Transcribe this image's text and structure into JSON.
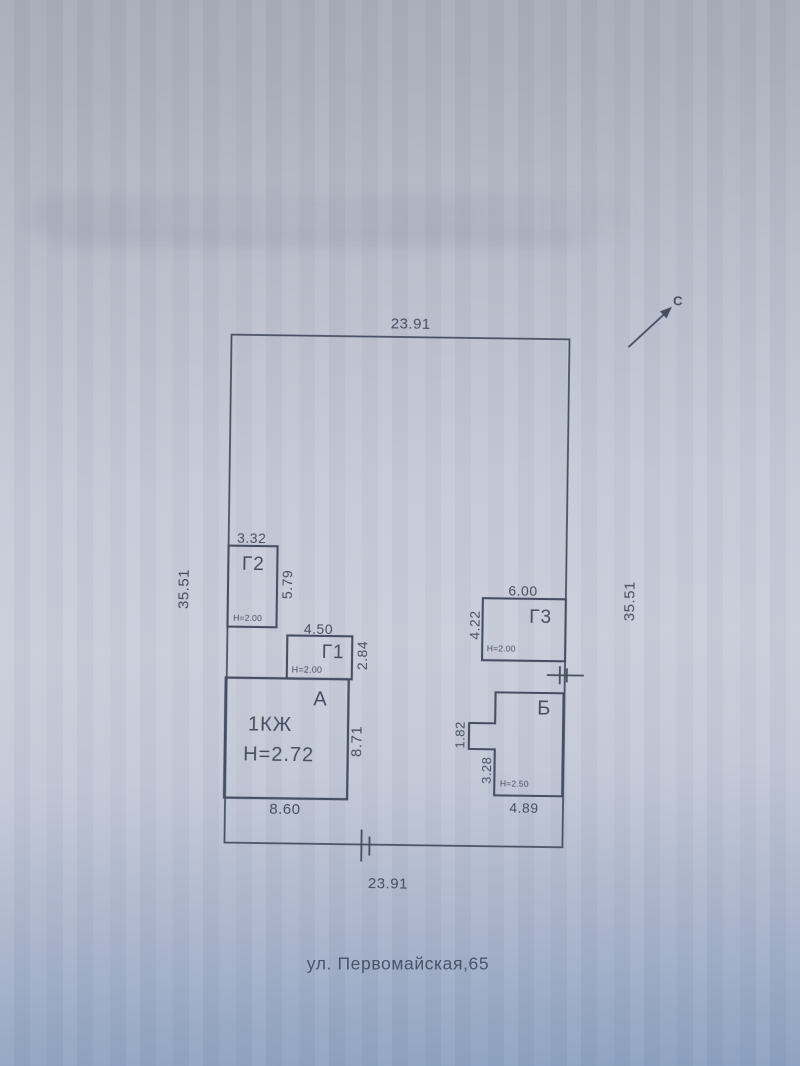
{
  "page": {
    "address": "ул. Первомайская,65"
  },
  "north": {
    "label": "С"
  },
  "plot": {
    "top": "23.91",
    "bottom": "23.91",
    "left": "35.51",
    "right": "35.51"
  },
  "buildings": {
    "a": {
      "label": "А",
      "storeys": "1КЖ",
      "height": "Н=2.72",
      "width": "8.60",
      "depth": "8.71"
    },
    "b": {
      "label": "Б",
      "height": "Н=2.50",
      "width": "4.89",
      "notch": "1.82",
      "side": "3.28"
    },
    "g1": {
      "label": "Г1",
      "height": "Н=2.00",
      "width": "4.50",
      "depth": "2.84"
    },
    "g2": {
      "label": "Г2",
      "height": "Н=2.00",
      "width": "3.32",
      "depth": "5.79"
    },
    "g3": {
      "label": "Г3",
      "height": "Н=2.00",
      "width": "6.00",
      "depth": "4.22"
    }
  },
  "colors": {
    "ink": "#454e62",
    "paper_top": "#a7acb8",
    "paper_mid": "#c9cdda",
    "paper_bottom": "#8ba0c0"
  }
}
